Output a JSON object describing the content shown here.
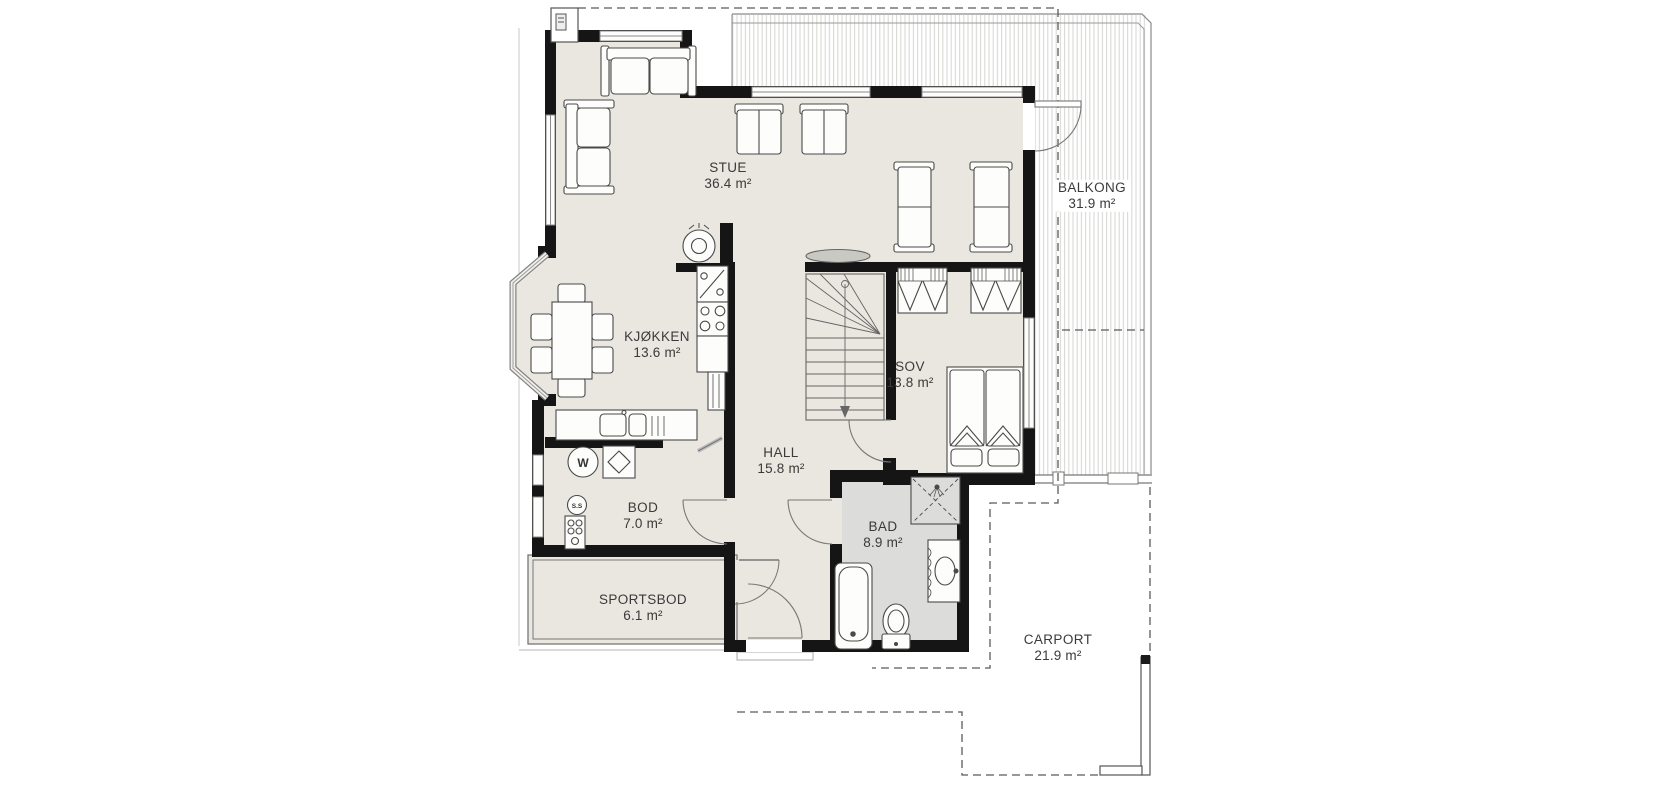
{
  "plan": {
    "type": "floor-plan",
    "language": "Norwegian"
  },
  "rooms": {
    "stue": {
      "name": "STUE",
      "area": "36.4 m²"
    },
    "kjokken": {
      "name": "KJØKKEN",
      "area": "13.6 m²"
    },
    "balkong": {
      "name": "BALKONG",
      "area": "31.9 m²"
    },
    "sov": {
      "name": "SOV",
      "area": "13.8 m²"
    },
    "hall": {
      "name": "HALL",
      "area": "15.8 m²"
    },
    "bod": {
      "name": "BOD",
      "area": "7.0 m²"
    },
    "bad": {
      "name": "BAD",
      "area": "8.9 m²"
    },
    "sportsbod": {
      "name": "SPORTSBOD",
      "area": "6.1 m²"
    },
    "carport": {
      "name": "CARPORT",
      "area": "21.9 m²"
    }
  },
  "fixtures": {
    "water_heater_label": "W",
    "ss_label": "S.S"
  },
  "colors": {
    "floor": "#e9e7e0",
    "bath_floor": "#dcddda",
    "wall": "#151515",
    "furniture_line": "#4a4a4a",
    "hatch": "#d5d5d2"
  }
}
